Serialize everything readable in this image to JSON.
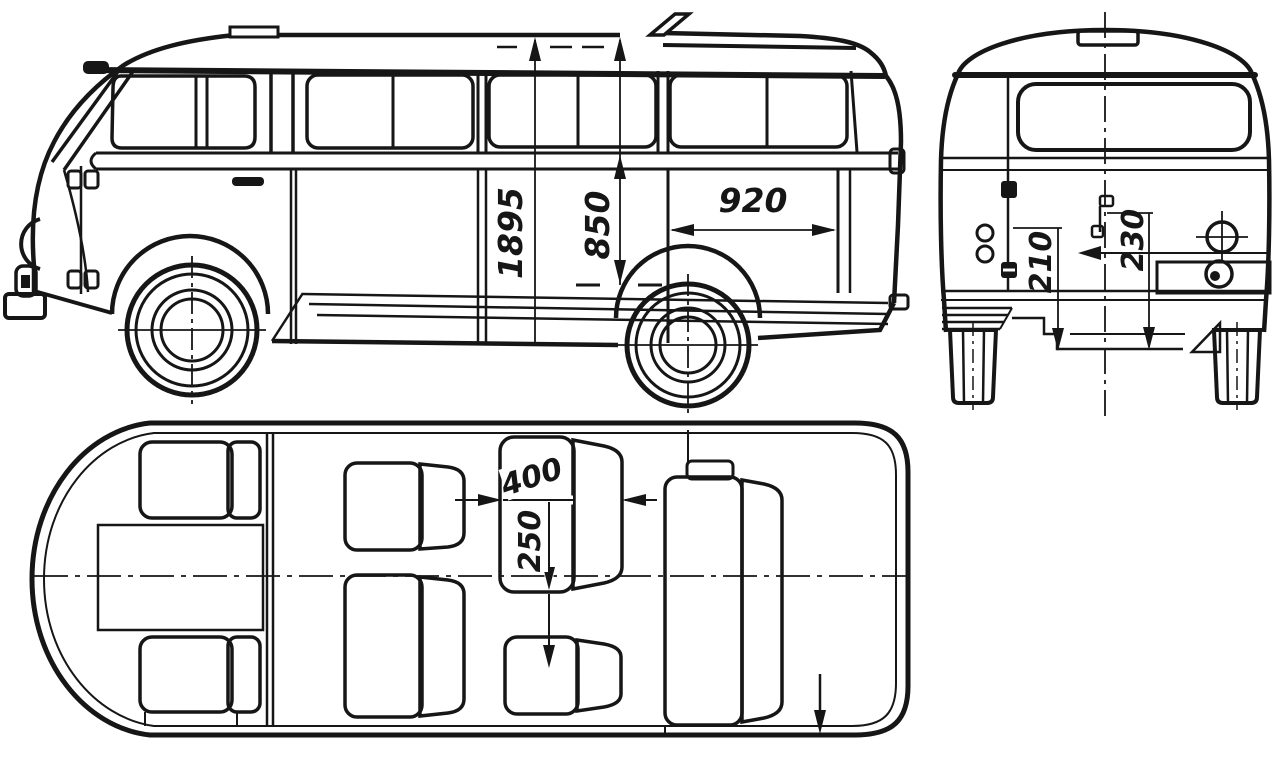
{
  "palette": {
    "ink": "#161616",
    "paper": "#ffffff"
  },
  "dimensions": {
    "overall_height": "1895",
    "sill_height": "850",
    "door_width": "920",
    "rear_step_left": "210",
    "rear_step_right": "230",
    "seat_depth": "400",
    "seat_spacing": "250"
  }
}
